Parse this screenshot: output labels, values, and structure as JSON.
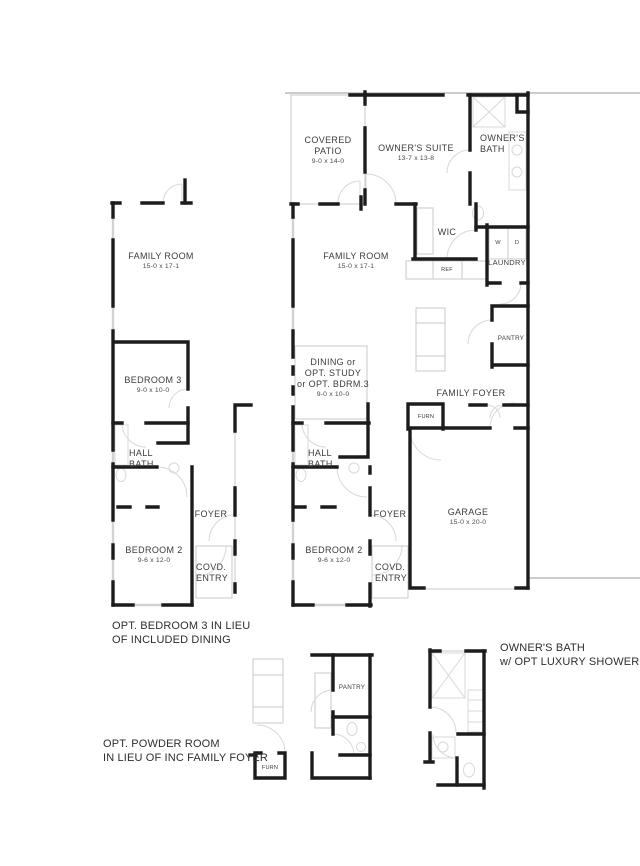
{
  "main_plan": {
    "covered_patio": {
      "lines": [
        "COVERED",
        "PATIO"
      ],
      "dim": "9-0 x 14-0"
    },
    "owners_suite": {
      "lines": [
        "OWNER'S SUITE"
      ],
      "dim": "13-7 x 13-8"
    },
    "owners_bath": {
      "lines": [
        "OWNER'S",
        "BATH"
      ]
    },
    "family_room": {
      "lines": [
        "FAMILY ROOM"
      ],
      "dim": "15-0 x 17-1"
    },
    "wic": {
      "label": "WIC"
    },
    "ref": {
      "label": "REF"
    },
    "washer": {
      "label": "W"
    },
    "dryer": {
      "label": "D"
    },
    "laundry": {
      "label": "LAUNDRY"
    },
    "pantry": {
      "label": "PANTRY"
    },
    "family_foyer": {
      "label": "FAMILY FOYER"
    },
    "furnace": {
      "label": "FURN"
    },
    "dining": {
      "lines": [
        "DINING or",
        "OPT. STUDY",
        "or OPT. BDRM.3"
      ],
      "dim": "9-0 x 10-0"
    },
    "hall_bath": {
      "lines": [
        "HALL",
        "BATH"
      ]
    },
    "foyer": {
      "label": "FOYER"
    },
    "bedroom_2": {
      "lines": [
        "BEDROOM 2"
      ],
      "dim": "9-6 x 12-0"
    },
    "covered_entry": {
      "lines": [
        "COVD.",
        "ENTRY"
      ]
    },
    "garage": {
      "lines": [
        "GARAGE"
      ],
      "dim": "15-0 x 20-0"
    }
  },
  "alt_bedroom3_plan": {
    "family_room": {
      "lines": [
        "FAMILY ROOM"
      ],
      "dim": "15-0 x 17-1"
    },
    "bedroom_3": {
      "lines": [
        "BEDROOM 3"
      ],
      "dim": "9-0 x 10-0"
    },
    "hall_bath": {
      "lines": [
        "HALL",
        "BATH"
      ]
    },
    "foyer": {
      "label": "FOYER"
    },
    "bedroom_2": {
      "lines": [
        "BEDROOM 2"
      ],
      "dim": "9-6 x 12-0"
    },
    "covered_entry": {
      "lines": [
        "COVD.",
        "ENTRY"
      ]
    },
    "caption": {
      "lines": [
        "OPT. BEDROOM 3 IN LIEU",
        "OF INCLUDED DINING"
      ]
    }
  },
  "powder_room_detail": {
    "pantry": {
      "label": "PANTRY"
    },
    "furnace": {
      "label": "FURN"
    },
    "caption": {
      "lines": [
        "OPT. POWDER ROOM",
        "IN LIEU OF INC FAMILY FOYER"
      ]
    }
  },
  "owners_bath_detail": {
    "caption": {
      "lines": [
        "OWNER'S BATH",
        "w/ OPT LUXURY SHOWER"
      ]
    }
  },
  "colors": {
    "wall": "#1c1c1c",
    "thin_line": "#c9c9c9",
    "fixture": "#d8d8d8",
    "text": "#3c3c3c",
    "background": "#ffffff"
  }
}
